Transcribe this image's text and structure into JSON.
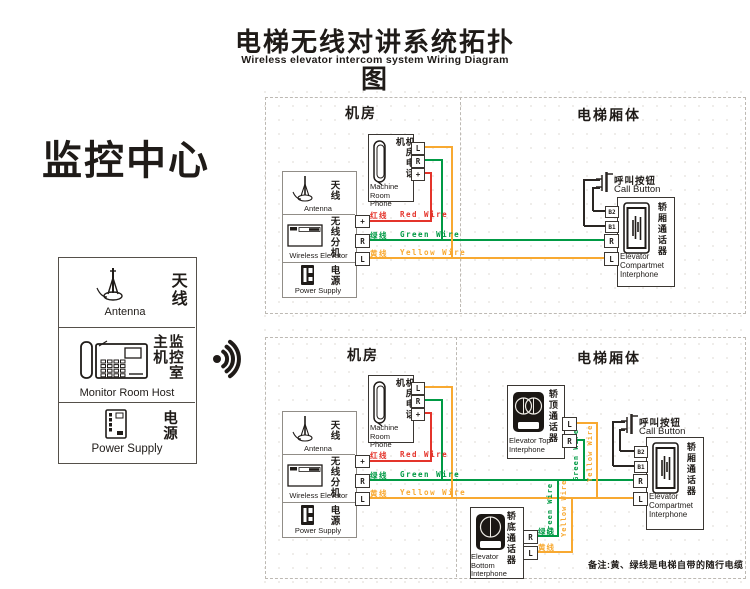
{
  "title": {
    "zh": "电梯无线对讲系统拓扑图",
    "en": "Wireless elevator intercom system Wiring Diagram"
  },
  "monitor_center": {
    "heading": "监控中心",
    "antenna": {
      "zh": "天线",
      "en": "Antenna"
    },
    "host": {
      "zh": "监控室主机",
      "en": "Monitor Room Host"
    },
    "power": {
      "zh": "电源",
      "en": "Power Supply"
    }
  },
  "section_labels": {
    "machine_room": "机房",
    "elevator_body": "电梯厢体"
  },
  "machine_phone": {
    "zh": "机房电话机",
    "en": "Machine Room Phone"
  },
  "equipment": {
    "antenna": {
      "zh": "天线",
      "en": "Antenna"
    },
    "wireless": {
      "zh": "无线分机",
      "en": "Wireless Elevator"
    },
    "power": {
      "zh": "电源",
      "en": "Power Supply"
    }
  },
  "call_button": {
    "zh": "呼叫按钮",
    "en": "Call Button"
  },
  "compartment_interphone": {
    "zh": "轿厢通话器",
    "en": "Elevator Compartmet Interphone"
  },
  "top_interphone": {
    "zh": "轿顶通话器",
    "en": "Elevator Top Interphone"
  },
  "bottom_interphone": {
    "zh": "轿底通话器",
    "en": "Elevator Bottom Interphone"
  },
  "terminals": {
    "l": "L",
    "r": "R",
    "plus": "+",
    "b1": "B1",
    "b2": "B2"
  },
  "wires": {
    "red": {
      "zh": "红线",
      "en": "Red Wire",
      "color": "#e4342b"
    },
    "green": {
      "zh": "绿线",
      "en": "Green Wire",
      "color": "#009a44"
    },
    "yellow": {
      "zh": "黄线",
      "en": "Yellow Wire",
      "color": "#f8a931"
    }
  },
  "note": "备注:黄、绿线是电梯自带的随行电缆"
}
